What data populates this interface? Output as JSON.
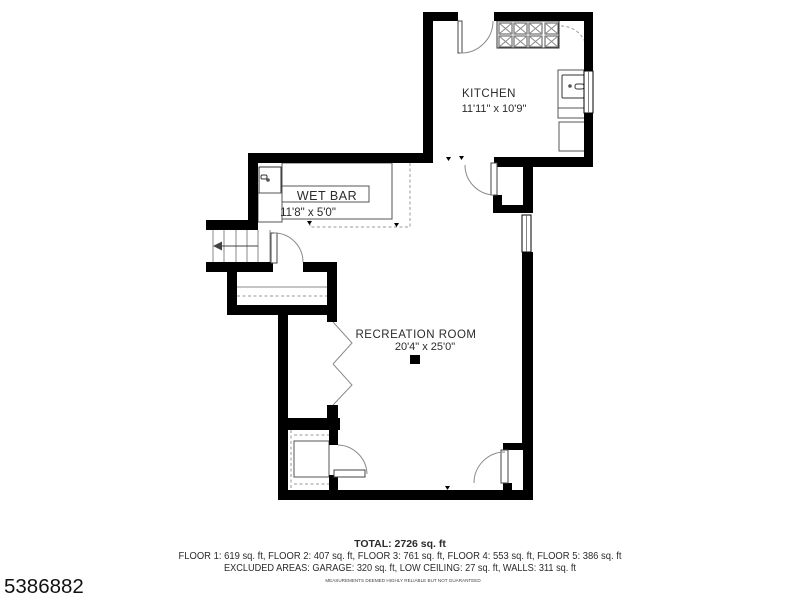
{
  "floorplan": {
    "rooms": [
      {
        "name": "KITCHEN",
        "dims": "11'11\" x 10'9\""
      },
      {
        "name": "WET BAR",
        "dims": "11'8\" x 5'0\""
      },
      {
        "name": "RECREATION ROOM",
        "dims": "20'4\" x 25'0\""
      }
    ]
  },
  "summary": {
    "total": "TOTAL: 2726 sq. ft",
    "floors": "FLOOR 1: 619 sq. ft, FLOOR 2: 407 sq. ft, FLOOR 3: 761 sq. ft, FLOOR 4: 553 sq. ft, FLOOR 5: 386 sq. ft",
    "excluded": "EXCLUDED AREAS: GARAGE: 320 sq. ft, LOW CEILING: 27 sq. ft, WALLS: 311 sq. ft",
    "disclaimer": "MEASUREMENTS DEEMED HIGHLY RELIABLE BUT NOT GUARANTEED"
  },
  "listing_id": "5386882",
  "colors": {
    "wall": "#000000",
    "fixture_line": "#555555",
    "dashed_line": "#999999",
    "text": "#2b2b2b"
  }
}
